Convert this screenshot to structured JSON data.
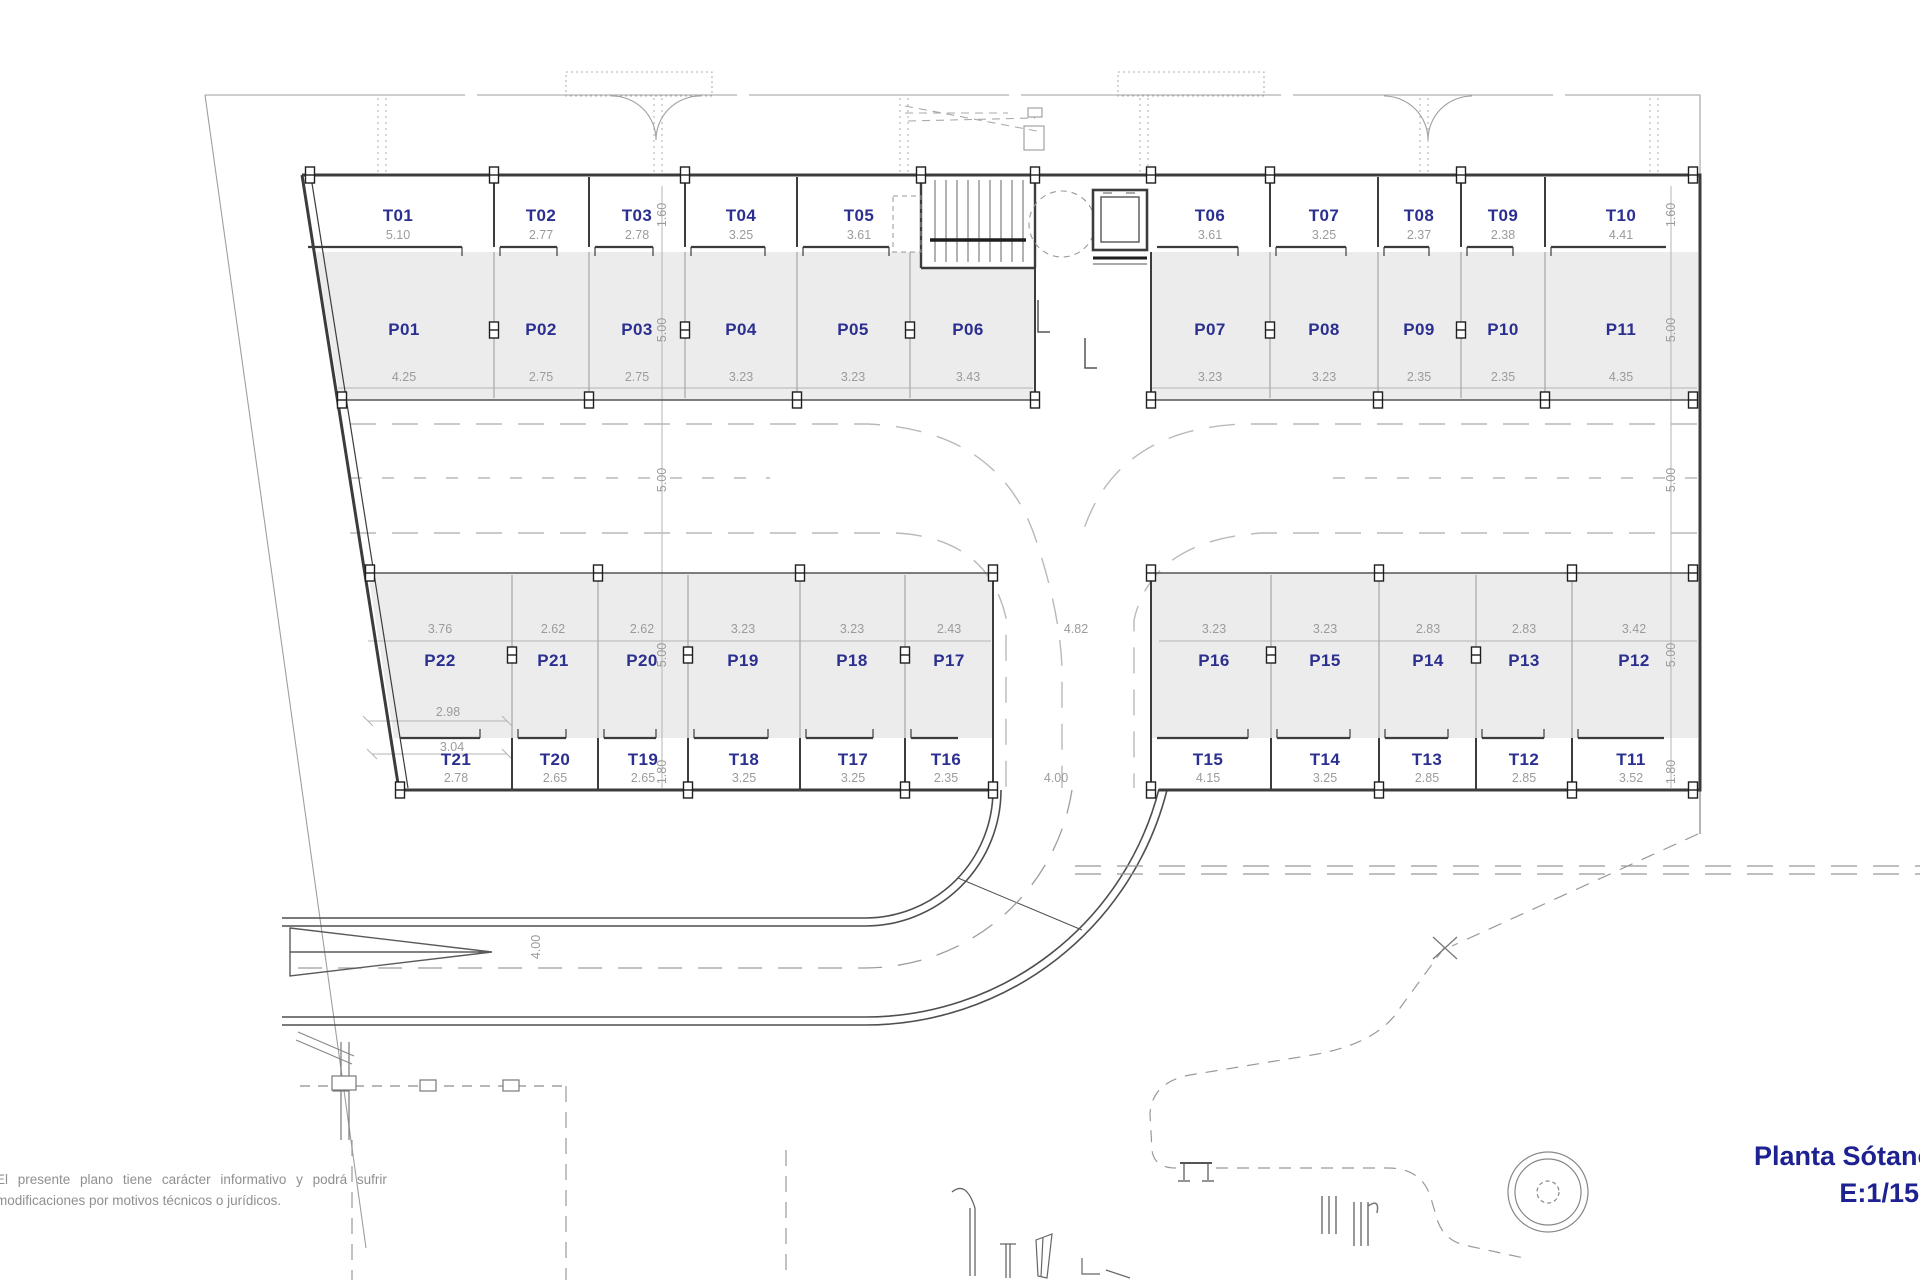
{
  "title": {
    "line1": "Planta Sótano",
    "line2": "E:1/150"
  },
  "disclaimer": {
    "line1": "El presente plano tiene carácter informativo y podrá sufrir",
    "line2": "modificaciones por motivos técnicos o jurídicos."
  },
  "colors": {
    "room_label_blue": "#2b2f8f",
    "title_blue": "#1d2290",
    "dim_gray": "#9b9b9b",
    "wall_dark": "#3c3c3c",
    "stall_fill": "#ececec",
    "light_line": "#b4b4b4"
  },
  "icons": [
    {
      "name": "staircase"
    },
    {
      "name": "elevator"
    },
    {
      "name": "turning-circle"
    },
    {
      "name": "ramp-arrow"
    },
    {
      "name": "bench"
    },
    {
      "name": "spiral-feature"
    }
  ],
  "plan": {
    "rows": [
      {
        "name": "storage-top",
        "label_y": 216,
        "dim_y": 235,
        "items": [
          {
            "id": "T01",
            "dim": "5.10",
            "cx": 398
          },
          {
            "id": "T02",
            "dim": "2.77",
            "cx": 541
          },
          {
            "id": "T03",
            "dim": "2.78",
            "cx": 637
          },
          {
            "id": "T04",
            "dim": "3.25",
            "cx": 741
          },
          {
            "id": "T05",
            "dim": "3.61",
            "cx": 859
          },
          {
            "id": "T06",
            "dim": "3.61",
            "cx": 1210
          },
          {
            "id": "T07",
            "dim": "3.25",
            "cx": 1324
          },
          {
            "id": "T08",
            "dim": "2.37",
            "cx": 1419
          },
          {
            "id": "T09",
            "dim": "2.38",
            "cx": 1503
          },
          {
            "id": "T10",
            "dim": "4.41",
            "cx": 1621
          }
        ]
      },
      {
        "name": "parking-top",
        "label_y": 330,
        "dim_y": 377,
        "items": [
          {
            "id": "P01",
            "dim": "4.25",
            "cx": 404
          },
          {
            "id": "P02",
            "dim": "2.75",
            "cx": 541
          },
          {
            "id": "P03",
            "dim": "2.75",
            "cx": 637
          },
          {
            "id": "P04",
            "dim": "3.23",
            "cx": 741
          },
          {
            "id": "P05",
            "dim": "3.23",
            "cx": 853
          },
          {
            "id": "P06",
            "dim": "3.43",
            "cx": 968
          },
          {
            "id": "P07",
            "dim": "3.23",
            "cx": 1210
          },
          {
            "id": "P08",
            "dim": "3.23",
            "cx": 1324
          },
          {
            "id": "P09",
            "dim": "2.35",
            "cx": 1419
          },
          {
            "id": "P10",
            "dim": "2.35",
            "cx": 1503
          },
          {
            "id": "P11",
            "dim": "4.35",
            "cx": 1621
          }
        ]
      },
      {
        "name": "parking-bottom",
        "label_y": 661,
        "dim_y": 629,
        "items": [
          {
            "id": "P22",
            "dim": "3.76",
            "cx": 440
          },
          {
            "id": "P21",
            "dim": "2.62",
            "cx": 553
          },
          {
            "id": "P20",
            "dim": "2.62",
            "cx": 642
          },
          {
            "id": "P19",
            "dim": "3.23",
            "cx": 743
          },
          {
            "id": "P18",
            "dim": "3.23",
            "cx": 852
          },
          {
            "id": "P17",
            "dim": "2.43",
            "cx": 949
          },
          {
            "id": "P16",
            "dim": "3.23",
            "cx": 1214
          },
          {
            "id": "P15",
            "dim": "3.23",
            "cx": 1325
          },
          {
            "id": "P14",
            "dim": "2.83",
            "cx": 1428
          },
          {
            "id": "P13",
            "dim": "2.83",
            "cx": 1524
          },
          {
            "id": "P12",
            "dim": "3.42",
            "cx": 1634
          }
        ]
      },
      {
        "name": "storage-bottom",
        "label_y": 760,
        "dim_y": 778,
        "items": [
          {
            "id": "T21",
            "dim": "2.78",
            "cx": 456
          },
          {
            "id": "T20",
            "dim": "2.65",
            "cx": 555
          },
          {
            "id": "T19",
            "dim": "2.65",
            "cx": 643
          },
          {
            "id": "T18",
            "dim": "3.25",
            "cx": 744
          },
          {
            "id": "T17",
            "dim": "3.25",
            "cx": 853
          },
          {
            "id": "T16",
            "dim": "2.35",
            "cx": 946
          },
          {
            "id": "T15",
            "dim": "4.15",
            "cx": 1208
          },
          {
            "id": "T14",
            "dim": "3.25",
            "cx": 1325
          },
          {
            "id": "T13",
            "dim": "2.85",
            "cx": 1427
          },
          {
            "id": "T12",
            "dim": "2.85",
            "cx": 1524
          },
          {
            "id": "T11",
            "dim": "3.52",
            "cx": 1631
          }
        ]
      }
    ],
    "loose_dims": [
      {
        "text": "1.60",
        "x": 662,
        "y": 215,
        "v": 1
      },
      {
        "text": "5.00",
        "x": 662,
        "y": 330,
        "v": 1
      },
      {
        "text": "5.00",
        "x": 662,
        "y": 480,
        "v": 1
      },
      {
        "text": "5.00",
        "x": 662,
        "y": 655,
        "v": 1
      },
      {
        "text": "1.80",
        "x": 662,
        "y": 772,
        "v": 1
      },
      {
        "text": "1.60",
        "x": 1671,
        "y": 215,
        "v": 1
      },
      {
        "text": "5.00",
        "x": 1671,
        "y": 330,
        "v": 1
      },
      {
        "text": "5.00",
        "x": 1671,
        "y": 480,
        "v": 1
      },
      {
        "text": "5.00",
        "x": 1671,
        "y": 655,
        "v": 1
      },
      {
        "text": "1.80",
        "x": 1671,
        "y": 772,
        "v": 1
      },
      {
        "text": "4.82",
        "x": 1076,
        "y": 629
      },
      {
        "text": "4.00",
        "x": 1056,
        "y": 778
      },
      {
        "text": "2.98",
        "x": 448,
        "y": 712
      },
      {
        "text": "3.04",
        "x": 452,
        "y": 747
      },
      {
        "text": "4.00",
        "x": 536,
        "y": 947,
        "v": 1
      }
    ]
  }
}
